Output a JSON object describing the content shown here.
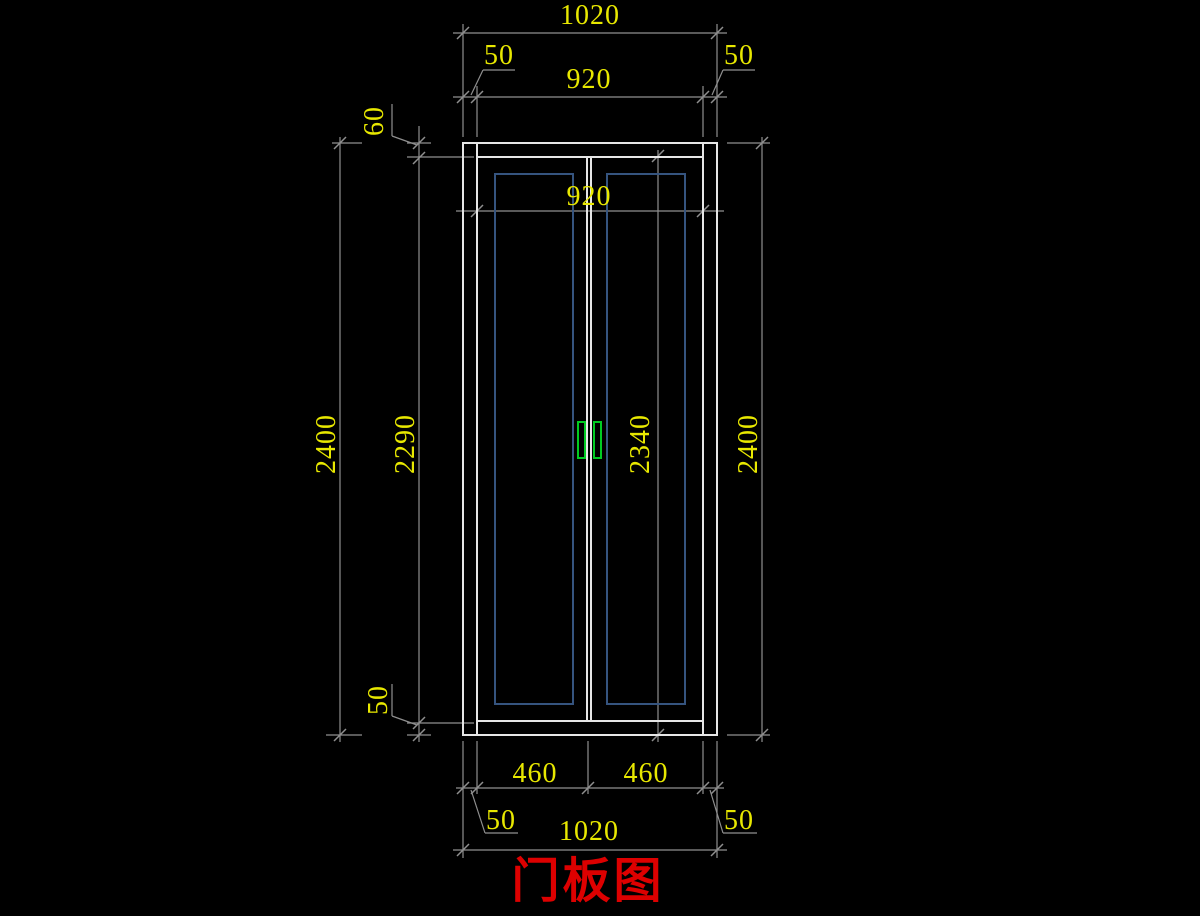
{
  "drawing_title": {
    "label": "门板图"
  },
  "colors": {
    "background": "#000000",
    "door_line": "#e6e6e6",
    "dimension_line": "#8f8f8f",
    "dimension_text": "#e8e800",
    "panel_line": "#35547f",
    "handle": "#00cc22",
    "title": "#dd0000"
  },
  "dimensions": {
    "top_overall_width": "1020",
    "top_left_stile": "50",
    "top_inner_width": "920",
    "top_right_stile": "50",
    "top_rail_height": "60",
    "door_inner_width": "920",
    "overall_height_left": "2400",
    "panel_region_height": "2290",
    "leaf_height": "2340",
    "overall_height_right": "2400",
    "bottom_rail_height": "50",
    "left_leaf_width": "460",
    "right_leaf_width": "460",
    "bottom_left_stile": "50",
    "bottom_overall_width": "1020",
    "bottom_right_stile": "50"
  }
}
